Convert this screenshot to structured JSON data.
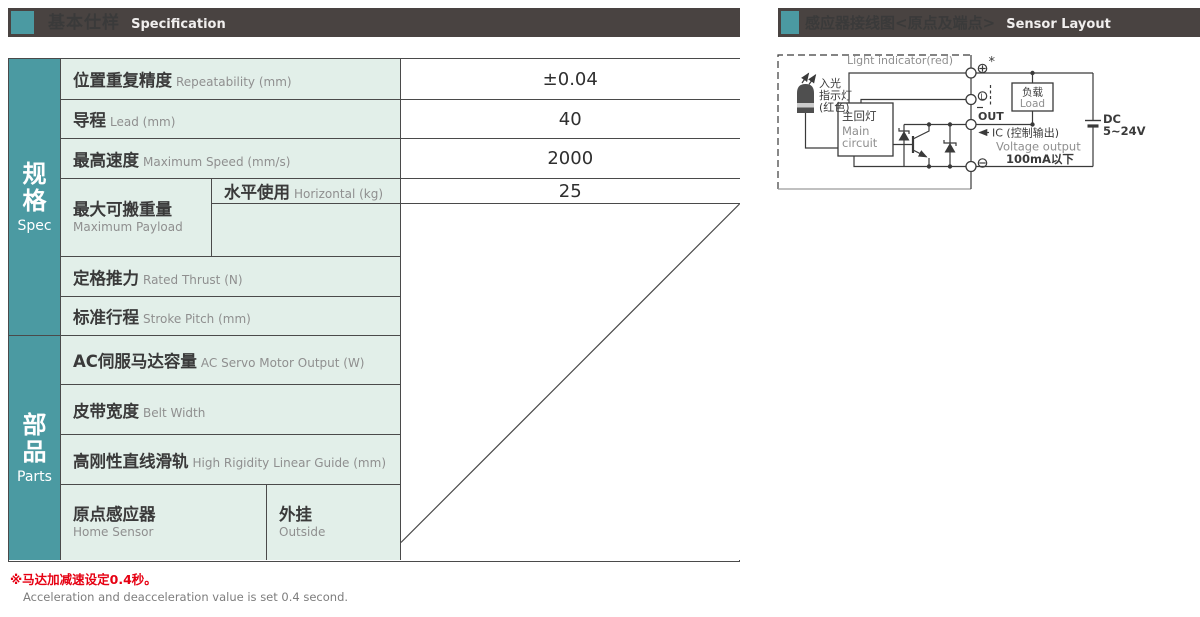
{
  "headers": {
    "left": {
      "zh": "基本仕样",
      "en": "Specification"
    },
    "right": {
      "zh": "感应器接线图<原点及端点>",
      "en": "Sensor Layout"
    }
  },
  "groups": {
    "spec": {
      "zh1": "规",
      "zh2": "格",
      "en": "Spec"
    },
    "parts": {
      "zh1": "部",
      "zh2": "品",
      "en": "Parts"
    }
  },
  "table": {
    "rows": [
      {
        "zh": "位置重复精度",
        "en": "Repeatability (mm)",
        "value": "±0.04"
      },
      {
        "zh": "导程",
        "en": "Lead (mm)",
        "value": "40"
      },
      {
        "zh": "最高速度",
        "en": "Maximum Speed (mm/s)",
        "value": "2000"
      },
      {
        "zh": "最大可搬重量",
        "en": "Maximum Payload",
        "sub1_zh": "水平使用",
        "sub1_en": "Horizontal (kg)",
        "sub1_value": "25",
        "sub2_zh": "垂直使用",
        "sub2_en": "Vertical (kg)",
        "sub2_value": ""
      },
      {
        "zh": "定格推力",
        "en": "Rated Thrust (N)",
        "value": "100"
      },
      {
        "zh": "标准行程",
        "en": "Stroke Pitch (mm)",
        "value": "50-3050mm/50间隔",
        "value_en": "50 mm Pitch"
      },
      {
        "zh": "AC伺服马达容量",
        "en": "AC Servo Motor Output (W)",
        "value": "200"
      },
      {
        "zh": "皮带宽度",
        "en": "Belt Width",
        "value": "25"
      },
      {
        "zh": "高刚性直线滑轨",
        "en": "High Rigidity Linear Guide (mm)",
        "value": "W15XH12.5"
      },
      {
        "zh": "原点感应器",
        "en": "Home Sensor",
        "sub_zh": "外挂",
        "sub_en": "Outside",
        "value": "EE-SX672(NPN)"
      }
    ]
  },
  "footnotes": {
    "zh": "※马达加减速设定0.4秒。",
    "en": "Acceleration and deacceleration value is set 0.4 second."
  },
  "diagram": {
    "light_indicator_en": "Light indicator(red)",
    "incident_zh_1": "入光",
    "incident_zh_2": "指示灯",
    "incident_zh_3": "(红色)",
    "main_circuit_zh": "主回灯",
    "main_circuit_en_1": "Main",
    "main_circuit_en_2": "circuit",
    "star": "*",
    "terminal_l": "L",
    "out": "OUT",
    "ic": "IC (控制输出)",
    "voltage_output": "Voltage output",
    "current": "100mA以下",
    "load_zh": "负载",
    "load_en": "Load",
    "dc1": "DC",
    "dc2": "5~24V"
  },
  "colors": {
    "teal": "#4b9aa2",
    "bar_bg": "#494341",
    "label_bg": "#e2efe9",
    "border": "#4a4a4a",
    "footnote_red": "#e60012"
  }
}
